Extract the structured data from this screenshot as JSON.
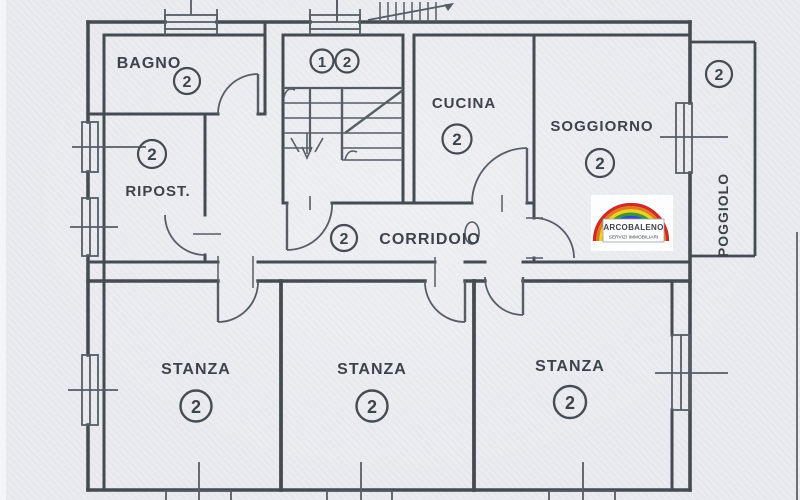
{
  "rooms": {
    "bagno": {
      "label": "BAGNO",
      "unit": "2"
    },
    "ripostiglio": {
      "label": "RIPOST.",
      "unit": "2"
    },
    "stairwell": {
      "units": [
        "1",
        "2"
      ]
    },
    "cucina": {
      "label": "CUCINA",
      "unit": "2"
    },
    "soggiorno": {
      "label": "SOGGIORNO",
      "unit": "2"
    },
    "corridoio": {
      "label": "CORRIDOIO",
      "unit": "2"
    },
    "stanza1": {
      "label": "STANZA",
      "unit": "2"
    },
    "stanza2": {
      "label": "STANZA",
      "unit": "2"
    },
    "stanza3": {
      "label": "STANZA",
      "unit": "2"
    },
    "poggiolo": {
      "label": "POGGIOLO",
      "unit": "2"
    }
  },
  "logo": {
    "name": "ARCOBALENO",
    "tagline": "SERVIZI IMMOBILIARI",
    "rainbow_colors": [
      "#cf2a27",
      "#e07c1e",
      "#ecd224",
      "#3e9437",
      "#2f4fbe",
      "#7b2f9e"
    ]
  },
  "colors": {
    "paper": "#e9ebf0",
    "ink": "#454b52"
  }
}
